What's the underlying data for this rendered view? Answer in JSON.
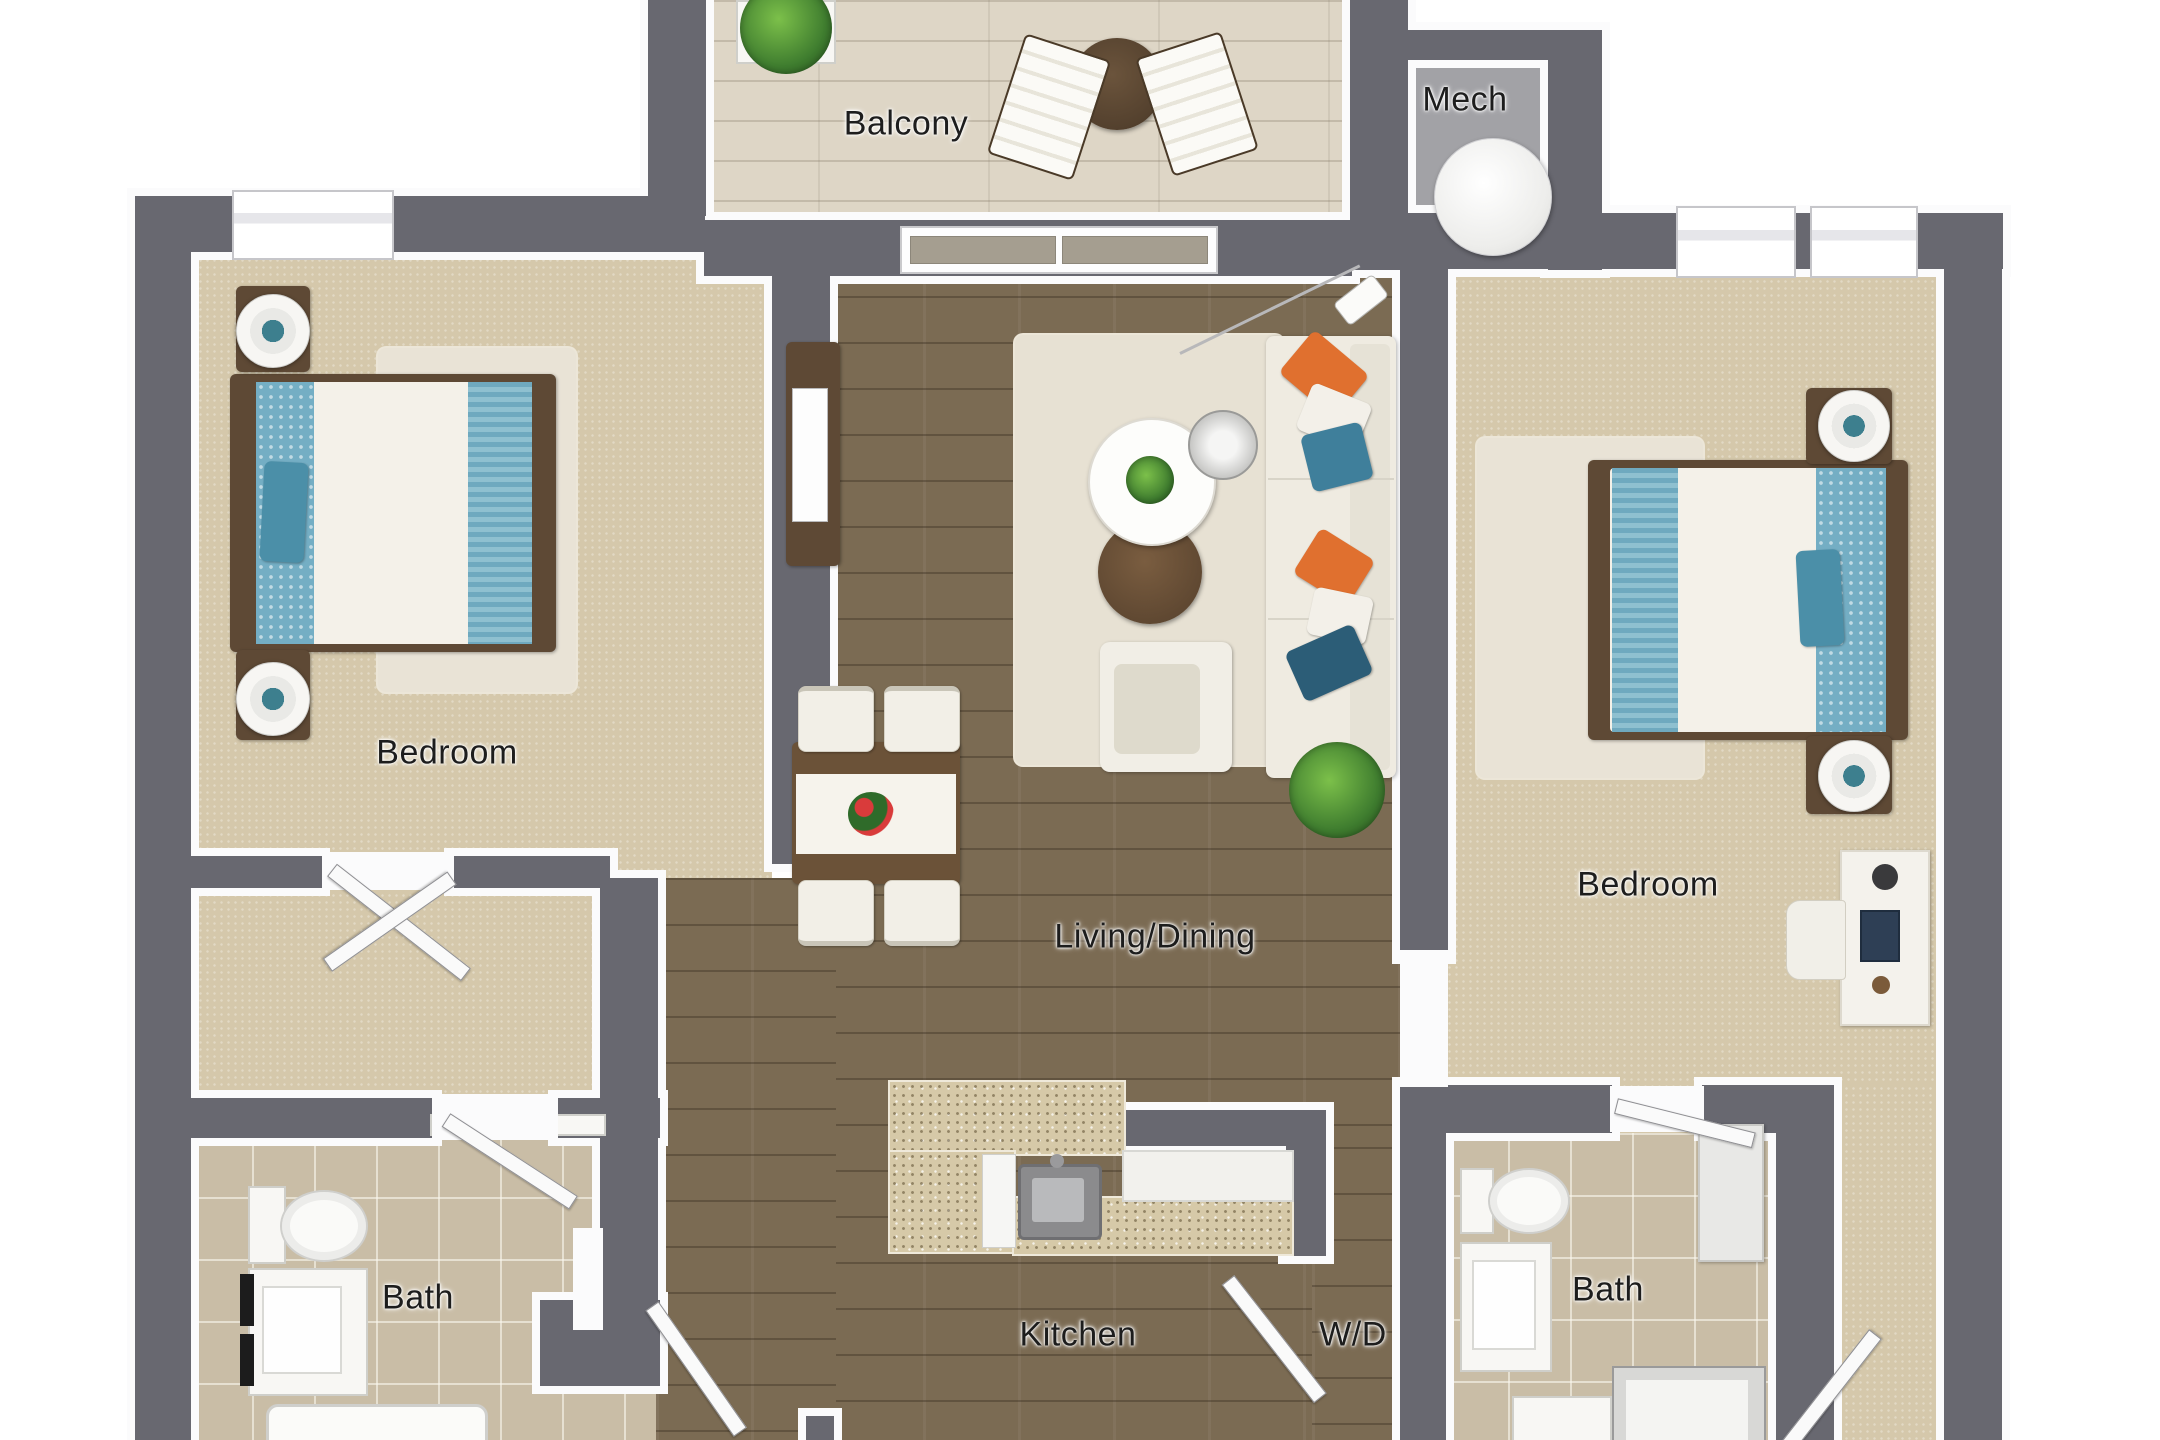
{
  "title": "Two-bedroom apartment 3D floor plan (top-down view)",
  "rooms": [
    {
      "id": "balcony",
      "label": "Balcony",
      "pos": {
        "x": 906,
        "y": 124
      }
    },
    {
      "id": "mech",
      "label": "Mech",
      "pos": {
        "x": 1465,
        "y": 100
      }
    },
    {
      "id": "bedroom-left",
      "label": "Bedroom",
      "pos": {
        "x": 447,
        "y": 753
      }
    },
    {
      "id": "living-dining",
      "label": "Living/Dining",
      "pos": {
        "x": 1155,
        "y": 937
      }
    },
    {
      "id": "bedroom-right",
      "label": "Bedroom",
      "pos": {
        "x": 1648,
        "y": 885
      }
    },
    {
      "id": "bath-left",
      "label": "Bath",
      "pos": {
        "x": 418,
        "y": 1298
      }
    },
    {
      "id": "kitchen",
      "label": "Kitchen",
      "pos": {
        "x": 1078,
        "y": 1335
      }
    },
    {
      "id": "laundry",
      "label": "W/D",
      "pos": {
        "x": 1353,
        "y": 1335
      }
    },
    {
      "id": "bath-right",
      "label": "Bath",
      "pos": {
        "x": 1608,
        "y": 1290
      }
    }
  ],
  "palette": {
    "wall": "#686870",
    "hardwood": "#7b6b53",
    "carpet": "#d5c8ab",
    "tile": "#c9bda6",
    "balcony_deck": "#ded6c6",
    "granite": "#d6c9a8",
    "accent_teal": "#6fa9bf",
    "accent_orange": "#e0702f",
    "wood_furniture": "#5e4935",
    "rug": "#e9e3d6"
  },
  "furniture": [
    "queen bed x2",
    "nightstands with round lamps x4",
    "white area rug x2",
    "sofa with orange, white and teal pillows",
    "round white coffee table with plant",
    "round wood coffee table",
    "glass side table",
    "arc floor lamp",
    "armchair",
    "dining table with white runner and flower centerpiece",
    "dining chairs x4",
    "TV console with TV",
    "potted plant",
    "kitchen island (granite) with sink",
    "dishwasher",
    "desk with chair, laptop, lamp",
    "toilet x2",
    "vanity sink x2",
    "bathtub",
    "shower",
    "tall bath cabinet",
    "water heater",
    "balcony bistro table",
    "lounge chairs x2",
    "planter"
  ]
}
